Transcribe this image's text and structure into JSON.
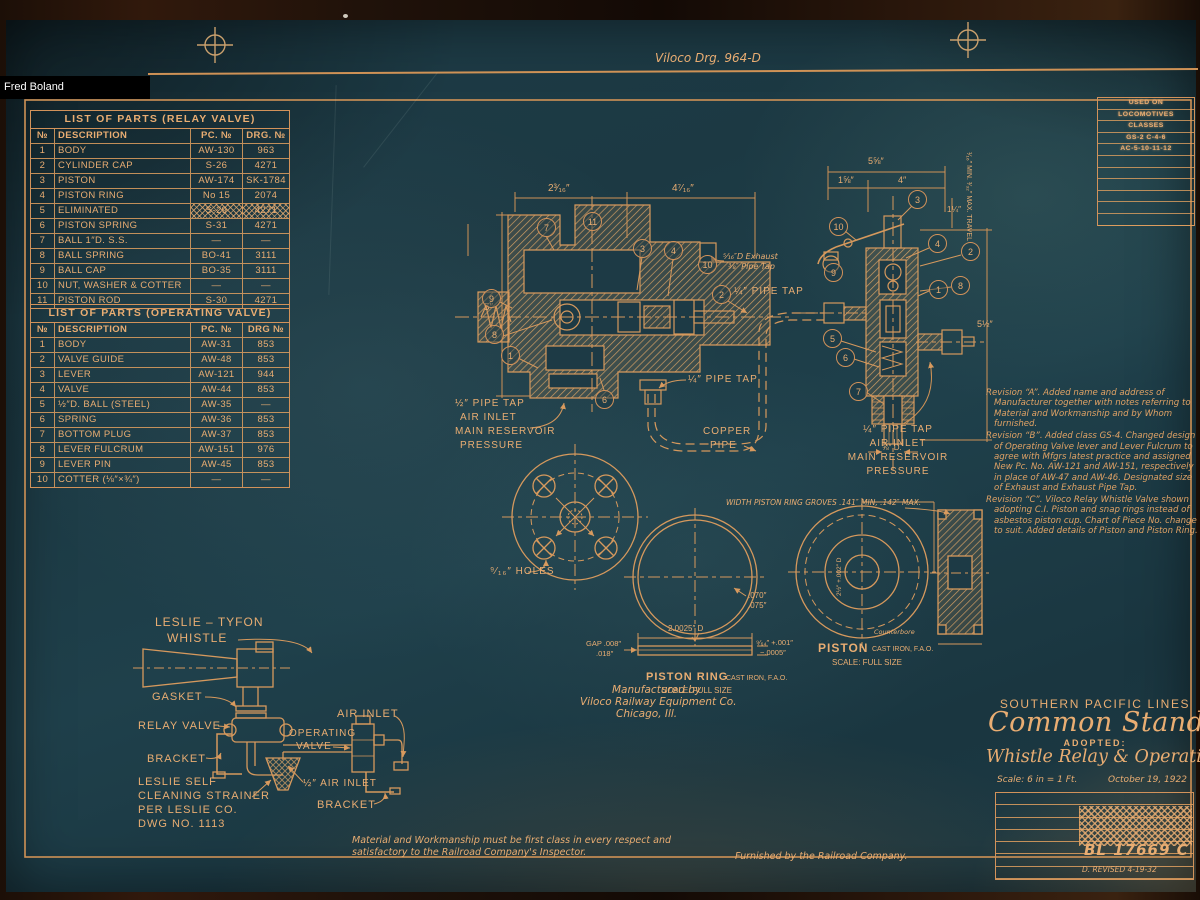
{
  "photo": {
    "credit": "Fred Boland"
  },
  "sheet": {
    "drawing_no": "Viloco Drg. 964-D"
  },
  "colors": {
    "ink": "#d2925a",
    "ink_bright": "#e9ad72",
    "paper": "#1d3a45"
  },
  "used_on": {
    "lines": [
      "USED ON",
      "LOCOMOTIVES",
      "CLASSES",
      "GS-2  C-4-6",
      "AC-5-10-11-12"
    ],
    "empty_rows": 6
  },
  "relay_table": {
    "title": "LIST OF PARTS (RELAY VALVE)",
    "headers": [
      "№",
      "DESCRIPTION",
      "PC. №",
      "DRG. №"
    ],
    "struck_rows": [
      4
    ],
    "rows": [
      [
        "1",
        "BODY",
        "AW-130",
        "963"
      ],
      [
        "2",
        "CYLINDER CAP",
        "S-26",
        "4271"
      ],
      [
        "3",
        "PISTON",
        "AW-174",
        "SK-1784"
      ],
      [
        "4",
        "PISTON RING",
        "No 15",
        "2074"
      ],
      [
        "5",
        "ELIMINATED",
        "S-29",
        "4271"
      ],
      [
        "6",
        "PISTON SPRING",
        "S-31",
        "4271"
      ],
      [
        "7",
        "BALL 1″D. S.S.",
        "—",
        "—"
      ],
      [
        "8",
        "BALL SPRING",
        "BO-41",
        "3111"
      ],
      [
        "9",
        "BALL CAP",
        "BO-35",
        "3111"
      ],
      [
        "10",
        "NUT, WASHER & COTTER",
        "—",
        "—"
      ],
      [
        "11",
        "PISTON ROD",
        "S-30",
        "4271"
      ]
    ]
  },
  "operating_table": {
    "title": "LIST OF PARTS (OPERATING VALVE)",
    "headers": [
      "№",
      "DESCRIPTION",
      "PC. №",
      "DRG №"
    ],
    "struck_rows": [],
    "rows": [
      [
        "1",
        "BODY",
        "AW-31",
        "853"
      ],
      [
        "2",
        "VALVE GUIDE",
        "AW-48",
        "853"
      ],
      [
        "3",
        "LEVER",
        "AW-121",
        "944"
      ],
      [
        "4",
        "VALVE",
        "AW-44",
        "853"
      ],
      [
        "5",
        "½″D. BALL (STEEL)",
        "AW-35",
        "—"
      ],
      [
        "6",
        "SPRING",
        "AW-36",
        "853"
      ],
      [
        "7",
        "BOTTOM PLUG",
        "AW-37",
        "853"
      ],
      [
        "8",
        "LEVER FULCRUM",
        "AW-151",
        "976"
      ],
      [
        "9",
        "LEVER PIN",
        "AW-45",
        "853"
      ],
      [
        "10",
        "COTTER (⅛″×¾″)",
        "—",
        "—"
      ]
    ]
  },
  "revisions": {
    "a": "Revision “A”. Added name and address of Manufacturer together with notes referring to Material and Workmanship and by Whom furnished.",
    "b": "Revision “B”. Added class GS-4. Changed design of Operating Valve lever and Lever Fulcrum to agree with Mfgrs latest practice and assigned New Pc. No. AW-121 and AW-151, respectively in place of AW-47 and AW-46. Designated size of Exhaust and Exhaust Pipe Tap.",
    "c": "Revision “C”. Viloco Relay Whistle Valve shown adopting C.I. Piston and snap rings instead of asbestos piston cup. Chart of Piece No. change to suit. Added details of Piston and Piston Ring."
  },
  "title_block": {
    "company": "SOUTHERN PACIFIC LINES",
    "standard": "Common Standard",
    "adopted": "ADOPTED:",
    "drawing_title": "Whistle Relay & Operating Valve",
    "scale": "Scale: 6 in = 1 Ft.",
    "date": "October 19, 1922",
    "number": "BL 17669 C",
    "revised": "D. REVISED 4-19-32"
  },
  "leslie": {
    "t1": "LESLIE – TYFON",
    "t2": "WHISTLE",
    "gasket": "GASKET",
    "relay": "RELAY VALVE",
    "bracket1": "BRACKET",
    "s1": "LESLIE SELF",
    "s2": "CLEANING STRAINER",
    "s3": "PER LESLIE CO.",
    "s4": "DWG NO. 1113",
    "op1": "OPERATING",
    "op2": "VALVE",
    "air": "AIR INLET",
    "half_air": "½″ AIR INLET",
    "bracket2": "BRACKET"
  },
  "relay_drawing": {
    "dim_a": "2³⁄₁₆″",
    "dim_b": "4⁷⁄₁₆″",
    "dim_h": "5″",
    "exhaust1": "⁵⁄₁₆″D Exhaust",
    "exhaust2": "⅜″ Pipe Tap",
    "tap_top": "¼″ PIPE TAP",
    "tap_mid": "¼″ PIPE TAP",
    "inlet1": "½″ PIPE TAP",
    "inlet2": "AIR INLET",
    "inlet3": "MAIN RESERVOIR",
    "inlet4": "PRESSURE",
    "copper1": "COPPER",
    "copper2": "PIPE",
    "holes": "⁹⁄₁₆″ HOLES",
    "callouts": [
      {
        "n": "7",
        "x": 546,
        "y": 227
      },
      {
        "n": "11",
        "x": 592,
        "y": 221
      },
      {
        "n": "3",
        "x": 642,
        "y": 248
      },
      {
        "n": "4",
        "x": 673,
        "y": 250
      },
      {
        "n": "10",
        "x": 707,
        "y": 264
      },
      {
        "n": "2",
        "x": 721,
        "y": 294
      },
      {
        "n": "9",
        "x": 491,
        "y": 298
      },
      {
        "n": "8",
        "x": 494,
        "y": 334
      },
      {
        "n": "1",
        "x": 510,
        "y": 355
      },
      {
        "n": "6",
        "x": 604,
        "y": 399
      }
    ]
  },
  "operating_drawing": {
    "dim_total": "5⅝″",
    "dim_l": "1⅝″",
    "dim_r": "4″",
    "dim_s": "1¼″",
    "travel": "¹⁄₁₆″ MIN. ³⁄₃₂″ MAX.  TRAVEL",
    "dim_h": "5½″",
    "rod": "⅝″ D.",
    "inlet1": "¼″ PIPE TAP",
    "inlet2": "AIR INLET",
    "inlet3": "MAIN RESERVOIR",
    "inlet4": "PRESSURE",
    "callouts": [
      {
        "n": "3",
        "x": 917,
        "y": 199
      },
      {
        "n": "10",
        "x": 838,
        "y": 226
      },
      {
        "n": "4",
        "x": 937,
        "y": 243
      },
      {
        "n": "2",
        "x": 970,
        "y": 251
      },
      {
        "n": "9",
        "x": 833,
        "y": 272
      },
      {
        "n": "8",
        "x": 960,
        "y": 285
      },
      {
        "n": "1",
        "x": 938,
        "y": 289
      },
      {
        "n": "5",
        "x": 832,
        "y": 338
      },
      {
        "n": "6",
        "x": 845,
        "y": 357
      },
      {
        "n": "7",
        "x": 858,
        "y": 391
      }
    ]
  },
  "piston_ring": {
    "note": "WIDTH PISTON RING GROVES .141″ MIN, .142″ MAX.",
    "t1": ".070″",
    "t2": ".075″",
    "dia": "2.0025″ D",
    "gap1": "GAP .008″",
    "gap2": ".018″",
    "w1": "⁹⁄₆₄″ +.001″",
    "w2": "−.0005″",
    "caption": "PISTON RING",
    "material": "CAST IRON, F.A.O.",
    "scale": "SCALE: FULL SIZE"
  },
  "piston": {
    "caption": "PISTON",
    "material": "CAST IRON, F.A.O.",
    "scale": "SCALE: FULL SIZE",
    "counterbore": "Counterbore",
    "dim_side": "2½″ +.002″ D"
  },
  "manufacturer": {
    "l1": "Manufactured by",
    "l2": "Viloco Railway Equipment Co.",
    "l3": "Chicago, Ill."
  },
  "notes": {
    "material": "Material and Workmanship must be first class in every respect and satisfactory to the Railroad Company's Inspector.",
    "furnished": "Furnished by the Railroad Company."
  }
}
